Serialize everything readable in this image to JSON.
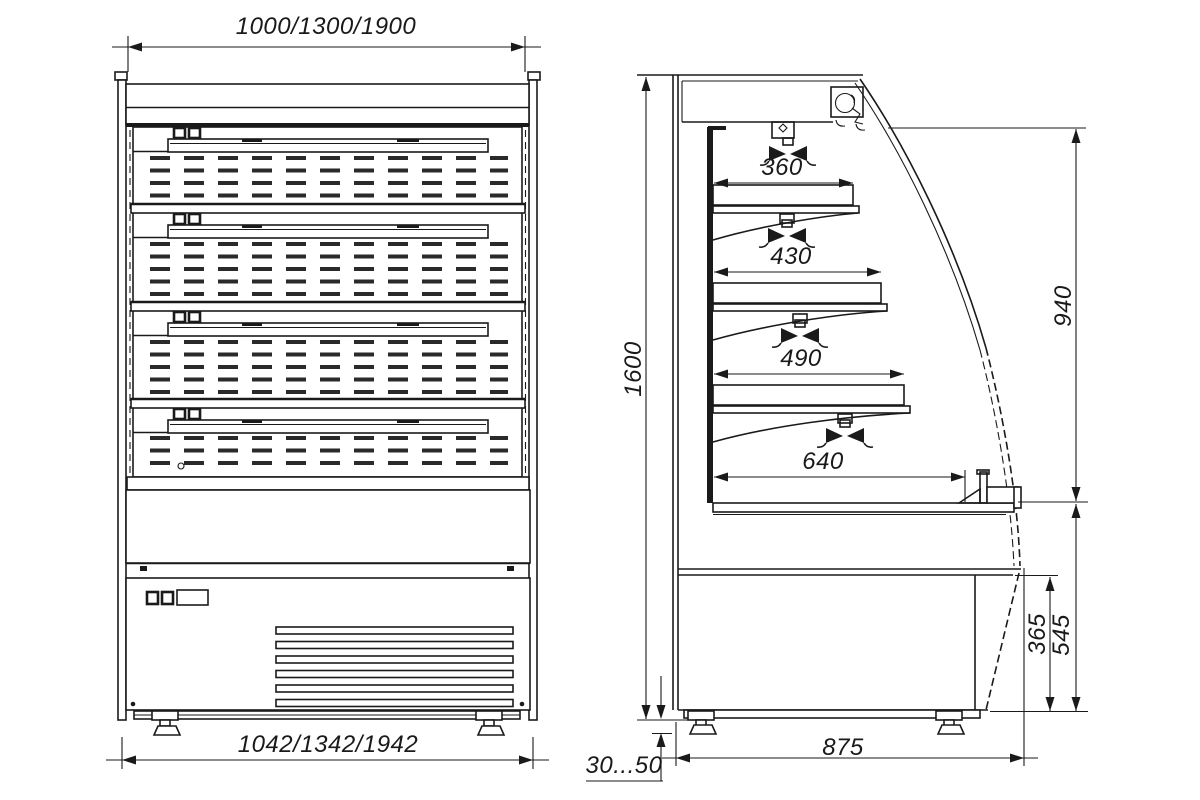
{
  "drawing_type": "dimensioned technical drawing, front and side views",
  "dims": {
    "front_width_top": "1000/1300/1900",
    "front_width_bottom": "1042/1342/1942",
    "height": "1600",
    "shelf_depths": [
      "360",
      "430",
      "490",
      "640"
    ],
    "opening_height": "940",
    "base_front_height": "365",
    "deck_height": "545",
    "depth": "875",
    "leg_adjust": "30...50"
  },
  "colors": {
    "line": "#1a1a1a",
    "background": "#ffffff"
  }
}
